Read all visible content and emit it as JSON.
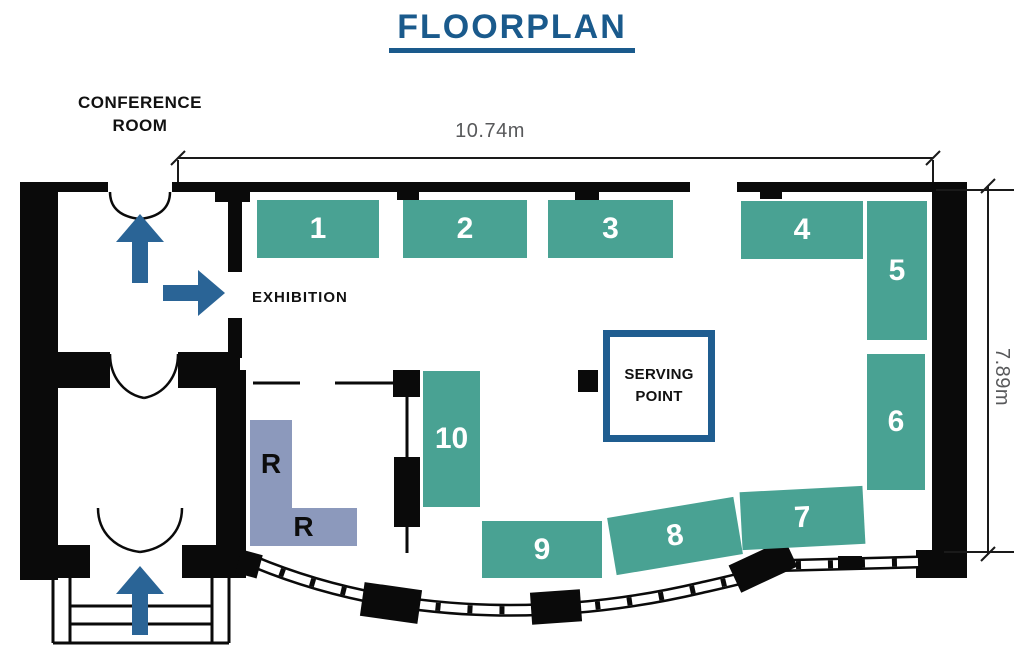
{
  "title": "FLOORPLAN",
  "rooms": {
    "conference_room": "CONFERENCE ROOM",
    "exhibition": "EXHIBITION",
    "serving_point": "SERVING POINT"
  },
  "dimensions": {
    "width_label": "10.74m",
    "height_label": "7.89m"
  },
  "booths": [
    {
      "id": "1",
      "label": "1"
    },
    {
      "id": "2",
      "label": "2"
    },
    {
      "id": "3",
      "label": "3"
    },
    {
      "id": "4",
      "label": "4"
    },
    {
      "id": "5",
      "label": "5"
    },
    {
      "id": "6",
      "label": "6"
    },
    {
      "id": "7",
      "label": "7"
    },
    {
      "id": "8",
      "label": "8"
    },
    {
      "id": "9",
      "label": "9"
    },
    {
      "id": "10",
      "label": "10"
    }
  ],
  "reserved_booths": [
    {
      "label": "R"
    },
    {
      "label": "R"
    }
  ],
  "colors": {
    "booth_teal": "#49A293",
    "r_lavender": "#8C99BC",
    "arrow_blue": "#2A6496",
    "title_blue": "#1A5A8C",
    "serving_border": "#1F5D90",
    "wall_black": "#0A0A0A",
    "dim_gray": "#58595B",
    "dim_line": "#1A1A1A"
  }
}
